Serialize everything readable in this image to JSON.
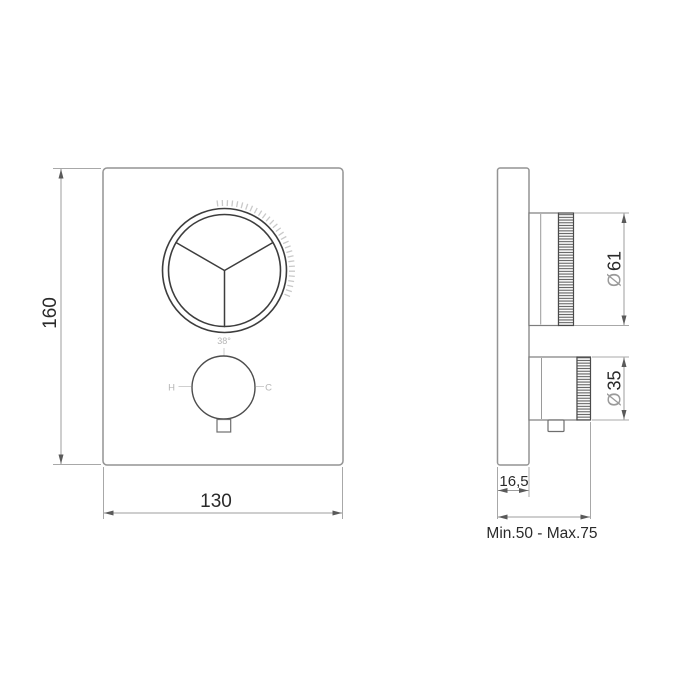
{
  "front_view": {
    "height_dim": "160",
    "width_dim": "130",
    "temp_knob": {
      "temp_label": "38°",
      "hot_label": "H",
      "cold_label": "C"
    }
  },
  "side_view": {
    "plate_depth_dim": "16,5",
    "diverter_diameter": {
      "symbol": "Ø",
      "value": "61"
    },
    "temp_diameter": {
      "symbol": "Ø",
      "value": "35"
    },
    "install_depth_dim": "Min.50 - Max.75"
  }
}
